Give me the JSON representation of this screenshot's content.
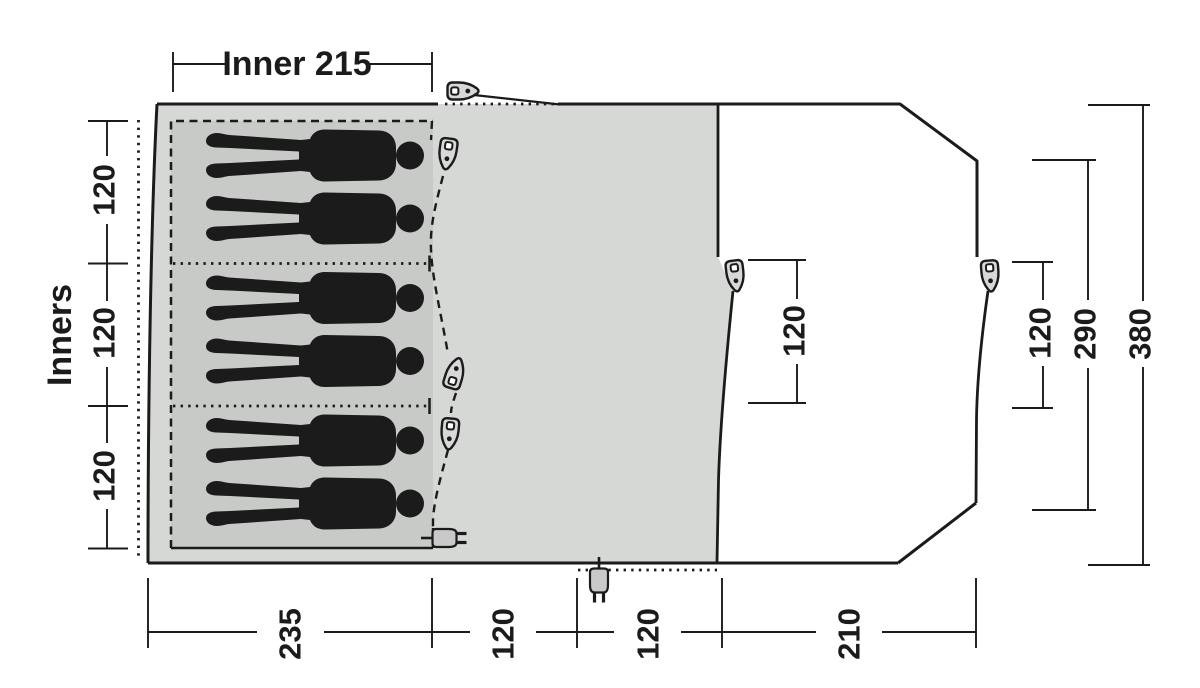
{
  "diagram": {
    "type": "tent-floorplan",
    "labels": {
      "inner_width": "Inner 215",
      "inners": "Inners"
    },
    "dimensions": {
      "left_segments": [
        "120",
        "120",
        "120"
      ],
      "door_offset": "120",
      "right_depths": [
        "120",
        "290",
        "380"
      ],
      "bottom_segments": [
        "235",
        "120",
        "120",
        "210"
      ]
    },
    "icons": {
      "peg": "guy-point-peg-icon",
      "plug": "power-plug-icon",
      "person": "sleeping-person-silhouette"
    },
    "colors": {
      "living_area": "#d6d8d5",
      "inner_area": "#c7cac6",
      "line": "#1b1b1b",
      "peg_fill": "#d8d8d8",
      "plug_fill": "#c9c9c9"
    }
  }
}
